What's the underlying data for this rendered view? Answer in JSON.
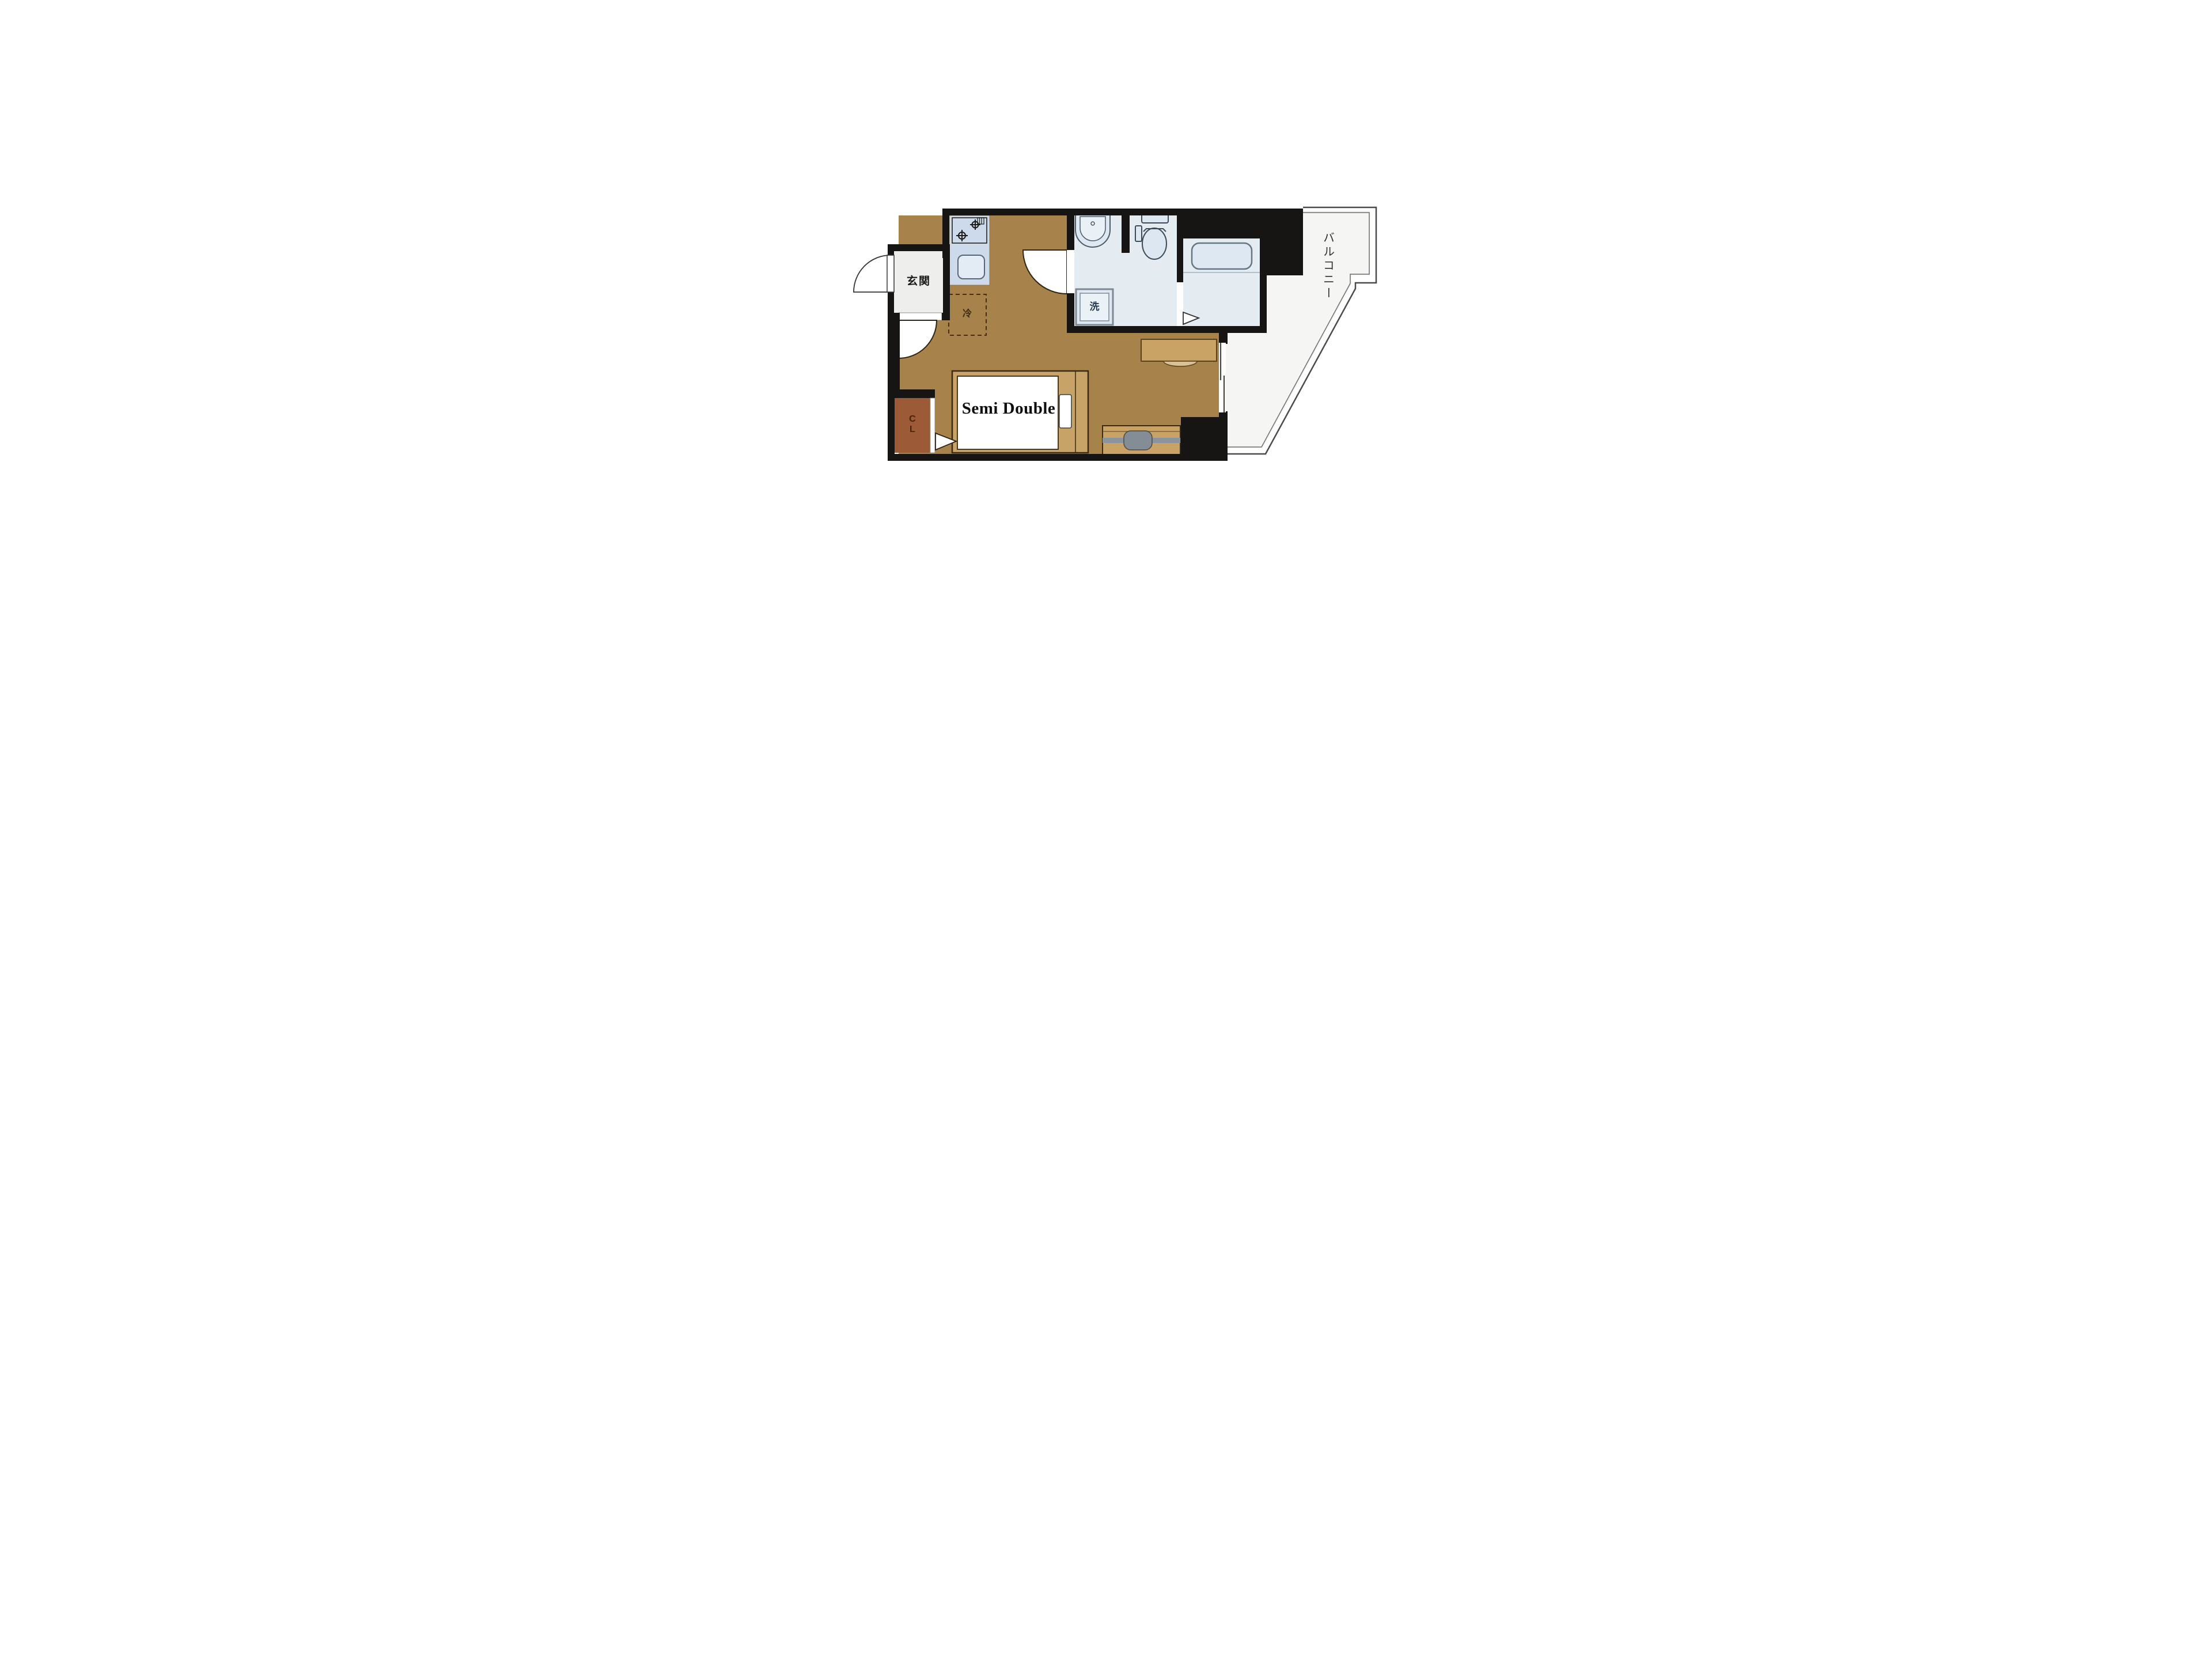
{
  "page": {
    "background": "#ffffff",
    "type": "apartment-floor-plan"
  },
  "floor_plan": {
    "labels": {
      "entrance": "玄関",
      "refrigerator": "冷",
      "washing_machine": "洗",
      "closet": "CL",
      "bed": "Semi Double",
      "balcony": "バルコニー"
    },
    "icons": [
      "entrance-door-arc-icon",
      "room-door-arc-icon",
      "washroom-door-arc-icon",
      "folding-door-triangle-icon",
      "stove-burner-icon",
      "kitchen-sink-icon",
      "washbasin-icon",
      "toilet-icon",
      "bathtub-icon",
      "washing-machine-icon",
      "bed-icon",
      "pillow-icon",
      "desk-icon",
      "chair-icon",
      "tv-board-icon",
      "sliding-window-icon"
    ],
    "colors": {
      "wall": "#171513",
      "room_floor": "#a7824a",
      "wet_room_floor": "#e4ecf2",
      "kitchen_counter": "#ccdae9",
      "fixture_fill": "#dde8f2",
      "fixture_outline": "#56667a",
      "genkan_floor": "#eeefec",
      "balcony_floor": "#f5f5f3",
      "bed_frame": "#c7a368",
      "mattress": "#ffffff",
      "furniture_tan": "#c9a266",
      "closet_fill": "#9c5a36",
      "tv_gray": "#858e97",
      "dashed_box": "#4a2c10"
    }
  }
}
